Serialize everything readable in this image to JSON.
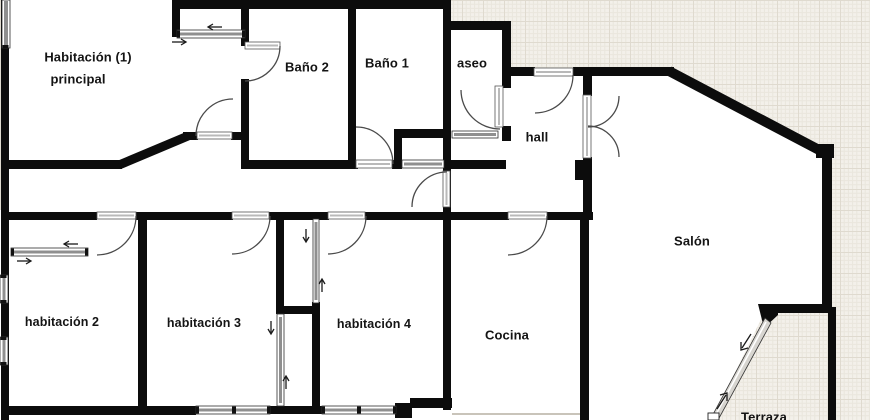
{
  "plan_title": "apartment-floor-plan",
  "rooms": {
    "principal_line1": "Habitación (1)",
    "principal_line2": "principal",
    "bano2": "Baño 2",
    "bano1": "Baño 1",
    "aseo": "aseo",
    "hall": "hall",
    "salon": "Salón",
    "habitacion2": "habitación 2",
    "habitacion3": "habitación 3",
    "habitacion4": "habitación 4",
    "cocina": "Cocina",
    "terraza": "Terraza"
  },
  "colors": {
    "wall": "#0c0c0c",
    "paper": "#f3f0ea",
    "grid_line": "#eae6dd",
    "grid_line_major": "#dfdacf",
    "interior": "#ffffff",
    "window_glass": "#8f8f8f",
    "door_arc": "#4a4a4a",
    "label_text": "#141414"
  }
}
